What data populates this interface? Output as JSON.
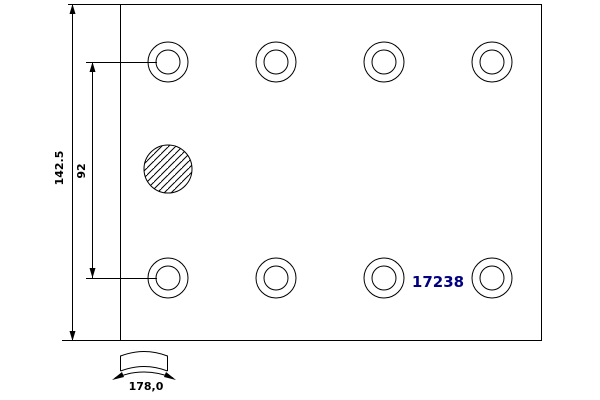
{
  "drawing": {
    "part_number": "17238",
    "dimensions": {
      "total_height_label": "142.5",
      "hole_row_spacing_label": "92",
      "arc_width_label": "178,0"
    },
    "features": {
      "rivet_hole_rows": 2,
      "rivet_holes_per_row": 4,
      "hatched_circles": 1
    },
    "colors": {
      "line": "#000000",
      "part_number_text": "#000080",
      "background": "#ffffff"
    }
  }
}
